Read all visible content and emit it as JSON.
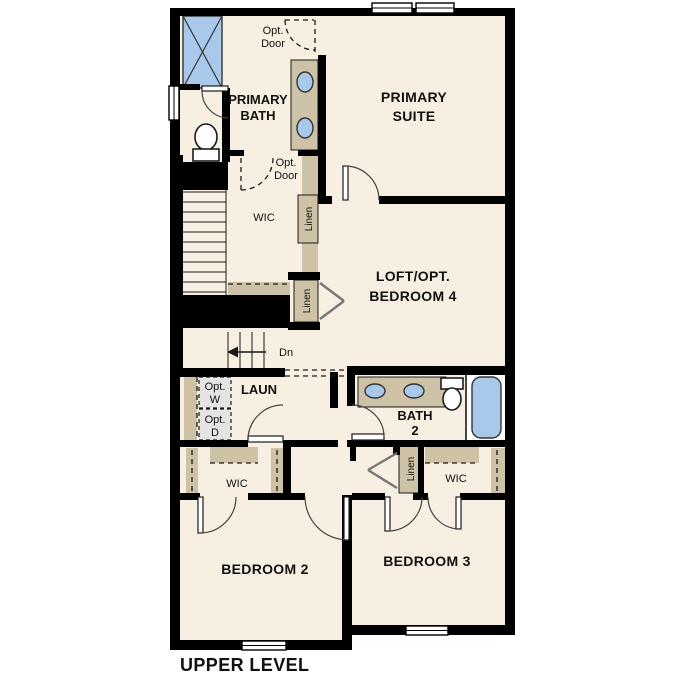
{
  "plan": {
    "title": "UPPER LEVEL",
    "level": "upper",
    "rooms": {
      "primary_suite_line1": "PRIMARY",
      "primary_suite_line2": "SUITE",
      "primary_bath_line1": "PRIMARY",
      "primary_bath_line2": "BATH",
      "loft_line1": "LOFT/OPT.",
      "loft_line2": "BEDROOM 4",
      "bedroom2": "BEDROOM 2",
      "bedroom3": "BEDROOM 3",
      "bath2_line1": "BATH",
      "bath2_line2": "2",
      "laundry": "LAUN",
      "wic_primary": "WIC",
      "wic_bedroom2": "WIC",
      "wic_bedroom3": "WIC",
      "linen_upper": "Linen",
      "linen_mid": "Linen",
      "linen_lower": "Linen"
    },
    "annotations": {
      "opt_door_top_line1": "Opt.",
      "opt_door_top_line2": "Door",
      "opt_door_wic_line1": "Opt.",
      "opt_door_wic_line2": "Door",
      "opt_washer_line1": "Opt.",
      "opt_washer_line2": "W",
      "opt_dryer_line1": "Opt.",
      "opt_dryer_line2": "D",
      "stairs_down": "Dn"
    },
    "fixtures": [
      "shower",
      "toilet",
      "double-vanity",
      "double-vanity-bath2",
      "toilet-bath2",
      "bathtub",
      "washer-space",
      "dryer-space"
    ],
    "colors": {
      "floor": "#f7efe2",
      "walls": "#000000",
      "casework_tan": "#cdc1a6",
      "fixture_blue": "#a9c9ea",
      "optional_gray": "#e4e4e4",
      "background": "#ffffff"
    }
  }
}
